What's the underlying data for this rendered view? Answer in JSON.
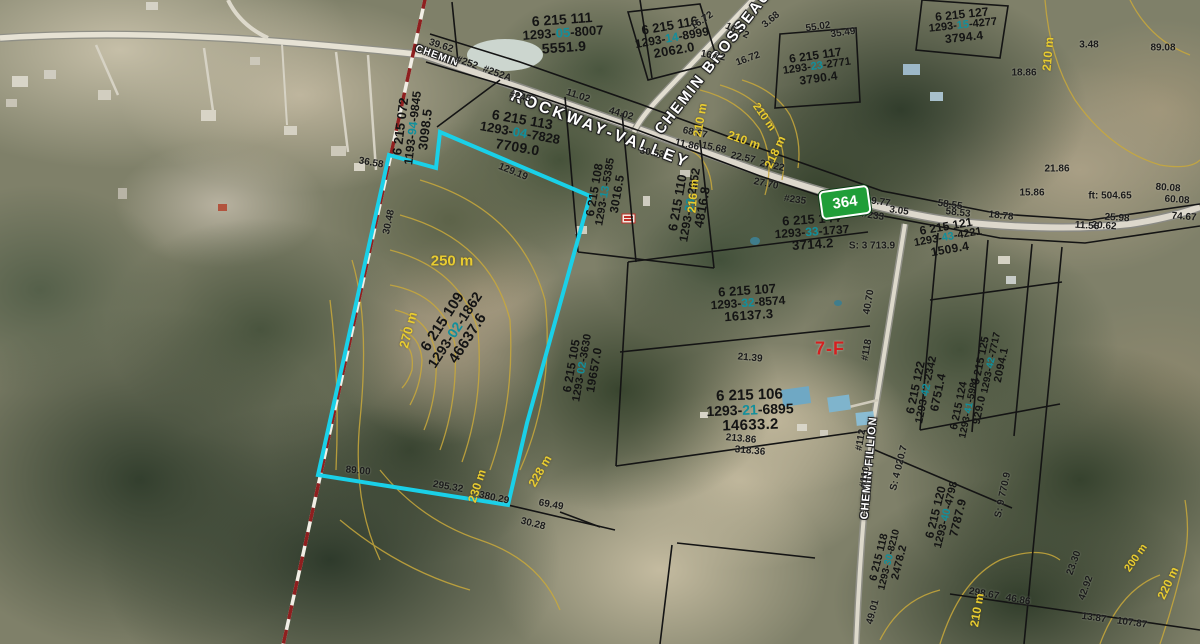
{
  "map": {
    "highway_shield": "364",
    "zone_label": "7-F",
    "selected_parcel": {
      "lot": "6 215 109",
      "matricule": "1293-02-1862",
      "area": "46637.6",
      "outline_color": "#1ad0e8"
    },
    "road_labels": [
      {
        "text": "ROCKWAY-VALLEY",
        "x": 600,
        "y": 130,
        "rot": 21,
        "size": 16,
        "ls": 3
      },
      {
        "text": "CHEMIN BROSSEAU",
        "x": 713,
        "y": 62,
        "rot": -52,
        "size": 15,
        "ls": 2
      },
      {
        "text": "CHEMIN FILLION",
        "x": 869,
        "y": 468,
        "rot": -85,
        "size": 11,
        "ls": 1
      },
      {
        "text": "CHEMIN",
        "x": 437,
        "y": 56,
        "rot": 20,
        "size": 10,
        "ls": 1
      }
    ],
    "parcels": [
      {
        "lot": "6 215 109",
        "mat": [
          "1293",
          "02",
          "1862"
        ],
        "area": "46637.6",
        "x": 455,
        "y": 330,
        "rot": -57,
        "size": 15
      },
      {
        "lot": "6 215 072",
        "mat": [
          "1193",
          "94",
          "9845"
        ],
        "area": "3098.5",
        "x": 413,
        "y": 128,
        "rot": -83,
        "size": 13
      },
      {
        "lot": "6 215 111",
        "mat": [
          "1293",
          "05",
          "8007"
        ],
        "area": "5551.9",
        "x": 563,
        "y": 33,
        "rot": -4,
        "size": 14
      },
      {
        "lot": "6 215 116",
        "mat": [
          "1293",
          "14",
          "8999"
        ],
        "area": "2062.0",
        "x": 672,
        "y": 38,
        "rot": -10,
        "size": 13
      },
      {
        "lot": "6 215 127",
        "mat": [
          "1293",
          "15",
          "4277"
        ],
        "area": "3794.4",
        "x": 963,
        "y": 26,
        "rot": -6,
        "size": 12
      },
      {
        "lot": "6 215 113",
        "mat": [
          "1293",
          "04",
          "7828"
        ],
        "area": "7709.0",
        "x": 520,
        "y": 133,
        "rot": 10,
        "size": 14
      },
      {
        "lot": "6 215 108",
        "mat": [
          "1293",
          "13",
          "5385"
        ],
        "area": "3016.5",
        "x": 606,
        "y": 192,
        "rot": -80,
        "size": 12
      },
      {
        "lot": "6 215 110",
        "mat": [
          "1293",
          "23",
          "2952"
        ],
        "area": "4816.8",
        "x": 690,
        "y": 205,
        "rot": -80,
        "size": 13
      },
      {
        "lot": "6 215 117",
        "mat": [
          "1293",
          "23",
          "2771"
        ],
        "area": "3790.4",
        "x": 817,
        "y": 67,
        "rot": -8,
        "size": 12
      },
      {
        "lot": "6 215 144",
        "mat": [
          "1293",
          "33",
          "1737"
        ],
        "area": "3714.2",
        "x": 812,
        "y": 232,
        "rot": -4,
        "size": 13
      },
      {
        "lot": "6 215 121",
        "mat": [
          "1293",
          "43",
          "4221"
        ],
        "area": "1509.4",
        "x": 948,
        "y": 238,
        "rot": -10,
        "size": 12
      },
      {
        "lot": "6 215 122",
        "mat": [
          "1293",
          "42",
          "2342"
        ],
        "area": "6751.4",
        "x": 927,
        "y": 390,
        "rot": -78,
        "size": 12
      },
      {
        "lot": "6 215 125",
        "mat": [
          "1293",
          "42",
          "7717"
        ],
        "area": "2094.1",
        "x": 992,
        "y": 363,
        "rot": -78,
        "size": 11
      },
      {
        "lot": "6 215 124",
        "mat": [
          "1293",
          "41",
          "5981"
        ],
        "area": "929.0",
        "x": 970,
        "y": 408,
        "rot": -78,
        "size": 11
      },
      {
        "lot": "6 215 120",
        "mat": [
          "1293",
          "40",
          "4798"
        ],
        "area": "7787.9",
        "x": 947,
        "y": 515,
        "rot": -76,
        "size": 12
      },
      {
        "lot": "6 215 118",
        "mat": [
          "1293",
          "30",
          "8210"
        ],
        "area": "2478.2",
        "x": 890,
        "y": 560,
        "rot": -76,
        "size": 11
      },
      {
        "lot": "6 215 107",
        "mat": [
          "1293",
          "32",
          "8574"
        ],
        "area": "16137.3",
        "x": 748,
        "y": 303,
        "rot": -4,
        "size": 13
      },
      {
        "lot": "6 215 106",
        "mat": [
          "1293",
          "21",
          "6895"
        ],
        "area": "14633.2",
        "x": 750,
        "y": 410,
        "rot": -2,
        "size": 15
      },
      {
        "lot": "6 215 105",
        "mat": [
          "1293",
          "02",
          "3630"
        ],
        "area": "19657.0",
        "x": 583,
        "y": 368,
        "rot": -80,
        "size": 12
      }
    ],
    "civic_numbers": [
      {
        "t": "#252",
        "x": 467,
        "y": 63,
        "r": 20
      },
      {
        "t": "#252A",
        "x": 497,
        "y": 74,
        "r": 20
      },
      {
        "t": "#243",
        "x": 520,
        "y": 97,
        "r": 12
      },
      {
        "t": "#235",
        "x": 795,
        "y": 200,
        "r": 8
      },
      {
        "t": "#233",
        "x": 873,
        "y": 216,
        "r": 8
      },
      {
        "t": "#118",
        "x": 867,
        "y": 350,
        "r": -80
      },
      {
        "t": "#112",
        "x": 861,
        "y": 440,
        "r": -80
      },
      {
        "t": "#110",
        "x": 865,
        "y": 477,
        "r": -80
      }
    ],
    "measurements": [
      {
        "t": "39.62",
        "x": 441,
        "y": 46,
        "r": 18
      },
      {
        "t": "11.02",
        "x": 578,
        "y": 96,
        "r": 18
      },
      {
        "t": "44.02",
        "x": 621,
        "y": 114,
        "r": 16
      },
      {
        "t": "68.67",
        "x": 695,
        "y": 133,
        "r": 12
      },
      {
        "t": "11.86",
        "x": 687,
        "y": 145,
        "r": 12
      },
      {
        "t": "15.68",
        "x": 714,
        "y": 148,
        "r": 12
      },
      {
        "t": "30.53",
        "x": 652,
        "y": 153,
        "r": 10
      },
      {
        "t": "22.57",
        "x": 743,
        "y": 158,
        "r": 12
      },
      {
        "t": "27.22",
        "x": 772,
        "y": 166,
        "r": 12
      },
      {
        "t": "27.70",
        "x": 766,
        "y": 184,
        "r": 12
      },
      {
        "t": "39.77",
        "x": 878,
        "y": 202,
        "r": 8
      },
      {
        "t": "3.05",
        "x": 899,
        "y": 211,
        "r": 8
      },
      {
        "t": "58.55",
        "x": 950,
        "y": 205,
        "r": 8
      },
      {
        "t": "58.53",
        "x": 958,
        "y": 213,
        "r": 6
      },
      {
        "t": "18.78",
        "x": 1001,
        "y": 216,
        "r": 6
      },
      {
        "t": "15.86",
        "x": 1032,
        "y": 193,
        "r": 0
      },
      {
        "t": "21.86",
        "x": 1057,
        "y": 169,
        "r": 0
      },
      {
        "t": "ft: 504.65",
        "x": 1110,
        "y": 196,
        "r": 0
      },
      {
        "t": "25.98",
        "x": 1117,
        "y": 218,
        "r": 4
      },
      {
        "t": "20.62",
        "x": 1104,
        "y": 226,
        "r": 4
      },
      {
        "t": "11.56",
        "x": 1087,
        "y": 226,
        "r": 4
      },
      {
        "t": "74.67",
        "x": 1184,
        "y": 217,
        "r": 4
      },
      {
        "t": "80.08",
        "x": 1168,
        "y": 188,
        "r": 4
      },
      {
        "t": "60.08",
        "x": 1177,
        "y": 200,
        "r": 4
      },
      {
        "t": "89.08",
        "x": 1163,
        "y": 48,
        "r": 0
      },
      {
        "t": "3.48",
        "x": 1089,
        "y": 45,
        "r": 0
      },
      {
        "t": "18.86",
        "x": 1024,
        "y": 73,
        "r": 0
      },
      {
        "t": "3.68",
        "x": 771,
        "y": 20,
        "r": -40
      },
      {
        "t": "55.02",
        "x": 818,
        "y": 27,
        "r": -8
      },
      {
        "t": "35.49",
        "x": 843,
        "y": 33,
        "r": -8
      },
      {
        "t": "16.72",
        "x": 702,
        "y": 21,
        "r": -35
      },
      {
        "t": "16.72",
        "x": 737,
        "y": 31,
        "r": 25
      },
      {
        "t": "16.72",
        "x": 713,
        "y": 56,
        "r": 10
      },
      {
        "t": "16.72",
        "x": 748,
        "y": 59,
        "r": -20
      },
      {
        "t": "30.48",
        "x": 389,
        "y": 222,
        "r": -78
      },
      {
        "t": "129.19",
        "x": 513,
        "y": 172,
        "r": 22
      },
      {
        "t": "36.58",
        "x": 371,
        "y": 163,
        "r": 10
      },
      {
        "t": "89.00",
        "x": 358,
        "y": 471,
        "r": 5
      },
      {
        "t": "295.32",
        "x": 448,
        "y": 487,
        "r": 10
      },
      {
        "t": "380.29",
        "x": 494,
        "y": 498,
        "r": 12
      },
      {
        "t": "69.49",
        "x": 551,
        "y": 505,
        "r": 10
      },
      {
        "t": "30.28",
        "x": 533,
        "y": 524,
        "r": 14
      },
      {
        "t": "21.39",
        "x": 750,
        "y": 358,
        "r": 5
      },
      {
        "t": "213.86",
        "x": 741,
        "y": 439,
        "r": 5
      },
      {
        "t": "318.36",
        "x": 750,
        "y": 451,
        "r": 5
      },
      {
        "t": "40.70",
        "x": 869,
        "y": 302,
        "r": -80
      },
      {
        "t": "49.01",
        "x": 873,
        "y": 612,
        "r": -75
      },
      {
        "t": "298.67",
        "x": 984,
        "y": 594,
        "r": 10
      },
      {
        "t": "46.86",
        "x": 1018,
        "y": 600,
        "r": 10
      },
      {
        "t": "13.87",
        "x": 1094,
        "y": 618,
        "r": 8
      },
      {
        "t": "107.87",
        "x": 1132,
        "y": 623,
        "r": 8
      },
      {
        "t": "23.30",
        "x": 1074,
        "y": 563,
        "r": -70
      },
      {
        "t": "42.92",
        "x": 1086,
        "y": 588,
        "r": -70
      },
      {
        "t": "S: 3 713.9",
        "x": 872,
        "y": 246,
        "r": 0
      },
      {
        "t": "S: 4 020.7",
        "x": 899,
        "y": 468,
        "r": -76
      },
      {
        "t": "S: 9 770.9",
        "x": 1003,
        "y": 495,
        "r": -78
      }
    ],
    "contour_labels": [
      {
        "t": "250 m",
        "x": 452,
        "y": 261,
        "r": 0,
        "size": 15
      },
      {
        "t": "270 m",
        "x": 408,
        "y": 330,
        "r": -75,
        "size": 13
      },
      {
        "t": "230 m",
        "x": 477,
        "y": 486,
        "r": -72,
        "size": 12
      },
      {
        "t": "228 m",
        "x": 540,
        "y": 471,
        "r": -60,
        "size": 12
      },
      {
        "t": "210 m",
        "x": 700,
        "y": 120,
        "r": -80,
        "size": 12
      },
      {
        "t": "210 m",
        "x": 744,
        "y": 140,
        "r": 20,
        "size": 12
      },
      {
        "t": "218 m",
        "x": 775,
        "y": 152,
        "r": -65,
        "size": 12
      },
      {
        "t": "216 m",
        "x": 693,
        "y": 196,
        "r": -85,
        "size": 12
      },
      {
        "t": "210 m",
        "x": 764,
        "y": 117,
        "r": 55,
        "size": 11
      },
      {
        "t": "210 m",
        "x": 1048,
        "y": 54,
        "r": -85,
        "size": 12
      },
      {
        "t": "210 m",
        "x": 977,
        "y": 610,
        "r": -80,
        "size": 12
      },
      {
        "t": "220 m",
        "x": 1168,
        "y": 583,
        "r": -65,
        "size": 12
      },
      {
        "t": "200 m",
        "x": 1136,
        "y": 558,
        "r": -55,
        "size": 11
      }
    ]
  },
  "colors": {
    "selected_outline": "#1ad0e8",
    "contour_line": "#c9a93b",
    "contour_label": "#e8cc30",
    "boundary_line": "#141414",
    "range_line_red": "#8e1f1f",
    "highway_shield_green": "#1f9e38",
    "zone_label_red": "#d42020",
    "matricule_highlight": "#128f9c"
  }
}
